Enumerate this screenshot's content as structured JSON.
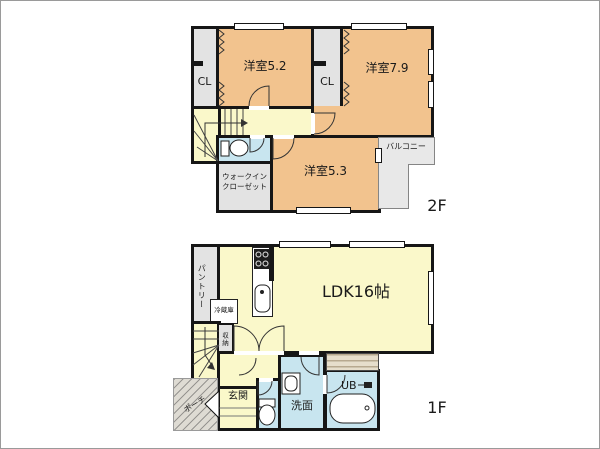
{
  "colors": {
    "wall": "#161616",
    "room_orange": "#F2C38E",
    "room_yellow": "#FAF8CA",
    "room_blue": "#C8E5EF",
    "closet_gray": "#E3E3E3",
    "balcony_gray": "#E8E8E8",
    "porch_gray": "#DEDBD3",
    "deck_tan": "#E6DECB"
  },
  "floor2": {
    "label": "2F",
    "bedroom_5_2": "洋室5.2",
    "bedroom_7_9": "洋室7.9",
    "bedroom_5_3": "洋室5.3",
    "closet_left": "CL",
    "closet_right": "CL",
    "wic_line1": "ウォークイン",
    "wic_line2": "クローゼット",
    "balcony": "バルコニー"
  },
  "floor1": {
    "label": "1F",
    "ldk": "LDK16帖",
    "pantry": "パントリー",
    "refrigerator": "冷蔵庫",
    "storage": "収納",
    "entrance": "玄関",
    "porch": "ポーチ",
    "washroom": "洗面",
    "unit_bath": "UB"
  }
}
